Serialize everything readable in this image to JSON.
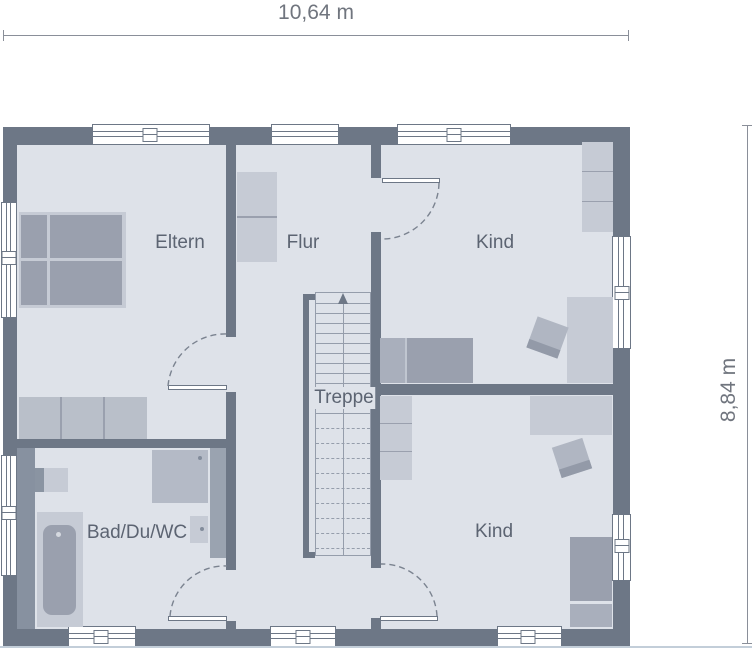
{
  "dimensions": {
    "width_label": "10,64 m",
    "height_label": "8,84 m"
  },
  "rooms": {
    "eltern": {
      "label": "Eltern"
    },
    "flur": {
      "label": "Flur"
    },
    "kind_top": {
      "label": "Kind"
    },
    "kind_bottom": {
      "label": "Kind"
    },
    "bad": {
      "label": "Bad/Du/WC"
    },
    "treppe": {
      "label": "Treppe"
    }
  },
  "stairs": {
    "solid_steps": 12,
    "dashed_steps": 9,
    "direction": "up"
  },
  "colors": {
    "wall": "#6d7786",
    "floor": "#dee2e9",
    "furnlight": "#c6cbd5",
    "wardrobe": "#b9bfc9",
    "furnmed": "#9aa0ae",
    "furnmed2": "#a9afbc",
    "chair": "#b0b6c2",
    "chairshade": "#939aa8",
    "stairline": "#959dab",
    "text": "#5c6472",
    "dim": "#70757e",
    "dimline": "#8a8f99",
    "install": "#8791a0",
    "install2": "#9aa3b0",
    "edgeline": "#c3ced9"
  }
}
